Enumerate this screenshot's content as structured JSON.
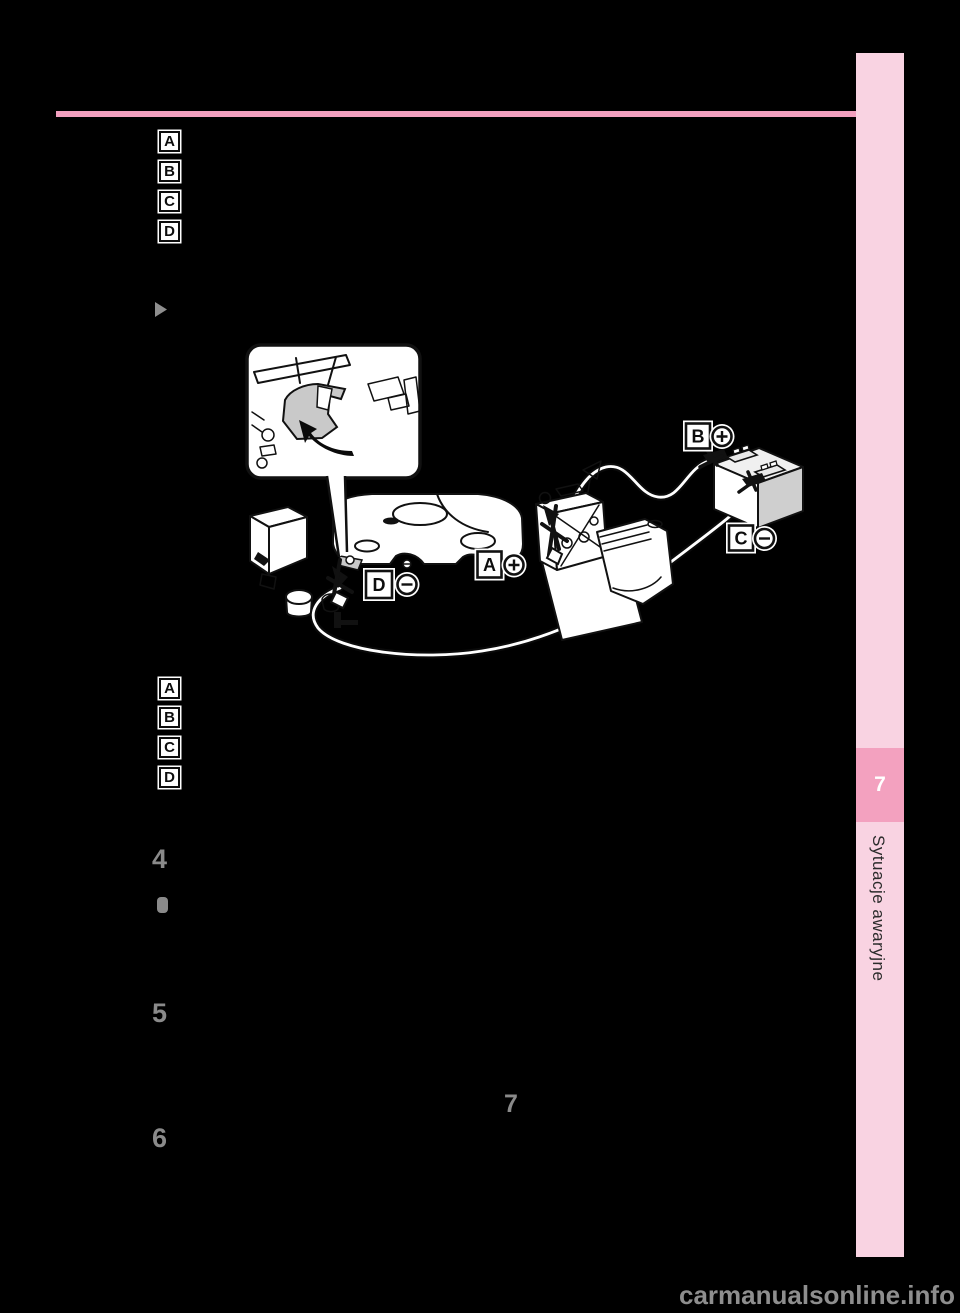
{
  "page": {
    "watermark": "carmanualsonline.info",
    "inline_page_number": "7",
    "step_numbers": [
      "4",
      "5",
      "6"
    ],
    "colors": {
      "background": "#000000",
      "step_number_gray": "#8a8a8a",
      "watermark_gray": "#8e8e8e"
    }
  },
  "sidebar": {
    "chapter_number": "7",
    "title": "Sytuacje awaryjne",
    "colors": {
      "panel_pink": "#f9d3e2",
      "badge_pink": "#f3a1bf",
      "divider_pink": "#f2a0bf",
      "title_text": "#2b2b2b",
      "chapter_number_text": "#ffffff"
    }
  },
  "legend_top": {
    "items": [
      "A",
      "B",
      "C",
      "D"
    ]
  },
  "legend_bottom": {
    "items": [
      "A",
      "B",
      "C",
      "D"
    ]
  },
  "diagram": {
    "description": "Jump-starting cable connection order illustration with discharged battery, booster battery and terminal markers",
    "markers": [
      {
        "letter": "A",
        "polarity": "plus"
      },
      {
        "letter": "B",
        "polarity": "plus"
      },
      {
        "letter": "C",
        "polarity": "minus"
      },
      {
        "letter": "D",
        "polarity": "minus"
      }
    ]
  }
}
